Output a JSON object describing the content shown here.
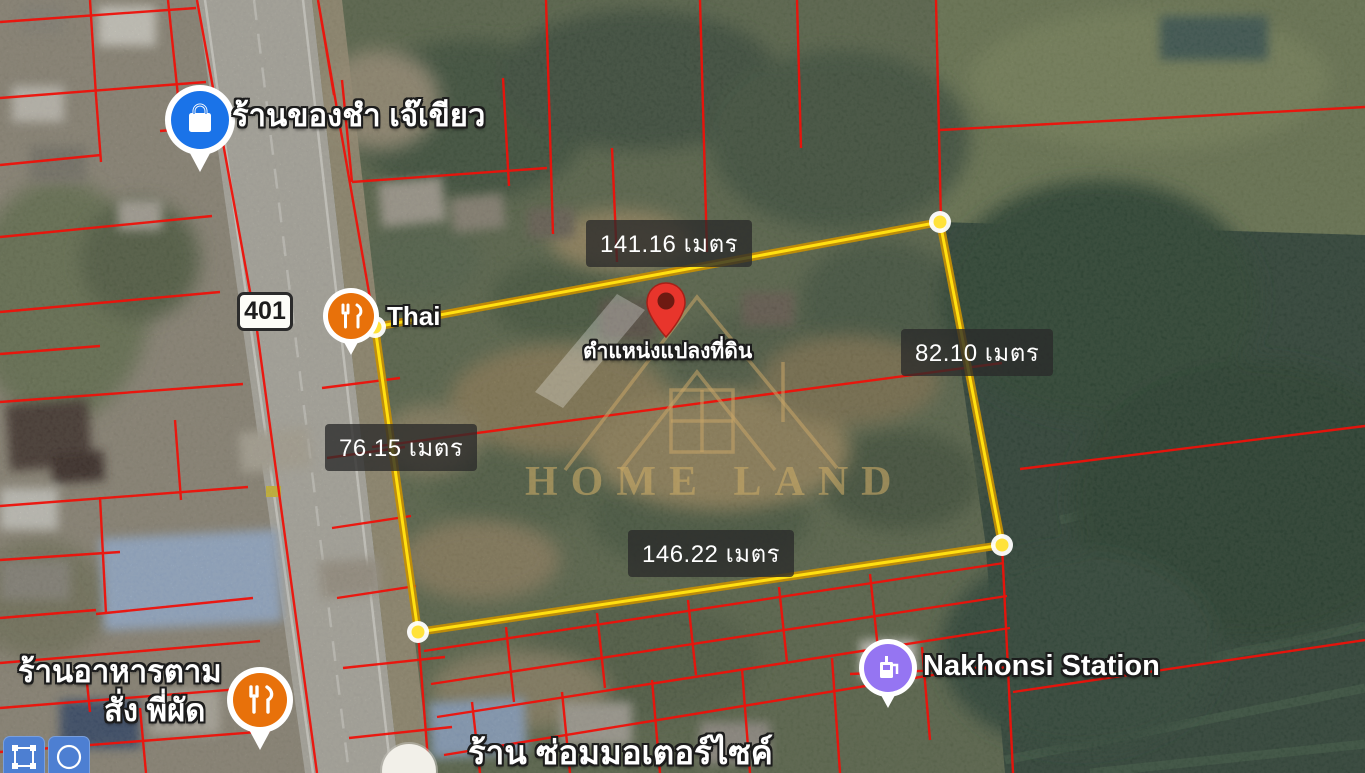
{
  "map": {
    "view": "satellite",
    "watermark": {
      "brand": "HOME LAND"
    },
    "road_shield": {
      "number": "401"
    },
    "parcel_lines_color": "#ee1109",
    "plot": {
      "location_label": "ตำแหน่งแปลงที่ดิน",
      "outline_color": "#e7b50d",
      "vertex_color": "#ffe23a",
      "measurements": {
        "top": {
          "label": "141.16 เมตร",
          "value": 141.16,
          "unit": "เมตร"
        },
        "right": {
          "label": "82.10 เมตร",
          "value": 82.1,
          "unit": "เมตร"
        },
        "left": {
          "label": "76.15 เมตร",
          "value": 76.15,
          "unit": "เมตร"
        },
        "bottom": {
          "label": "146.22 เมตร",
          "value": 146.22,
          "unit": "เมตร"
        }
      }
    },
    "pois": {
      "grocery": {
        "label": "ร้านของชำ เจ๊เขียว",
        "icon": "shopping-bag",
        "color": "#1a73e8"
      },
      "thai_restaurant": {
        "label": "Thai",
        "icon": "restaurant",
        "color": "#e8710a"
      },
      "station": {
        "label": "Nakhonsi Station",
        "icon": "fuel-pump",
        "color": "#9575f2"
      },
      "food_stall": {
        "label_line1": "ร้านอาหารตาม",
        "label_line2": "สั่ง พี่ผัด",
        "icon": "restaurant",
        "color": "#e8710a"
      },
      "motorcycle_repair": {
        "label": "ร้าน ซ่อมมอเตอร์ไซค์"
      }
    },
    "toolbar": {
      "color": "#4d7fd2",
      "tools": [
        {
          "name": "draw-rectangle"
        },
        {
          "name": "draw-circle"
        }
      ]
    }
  }
}
